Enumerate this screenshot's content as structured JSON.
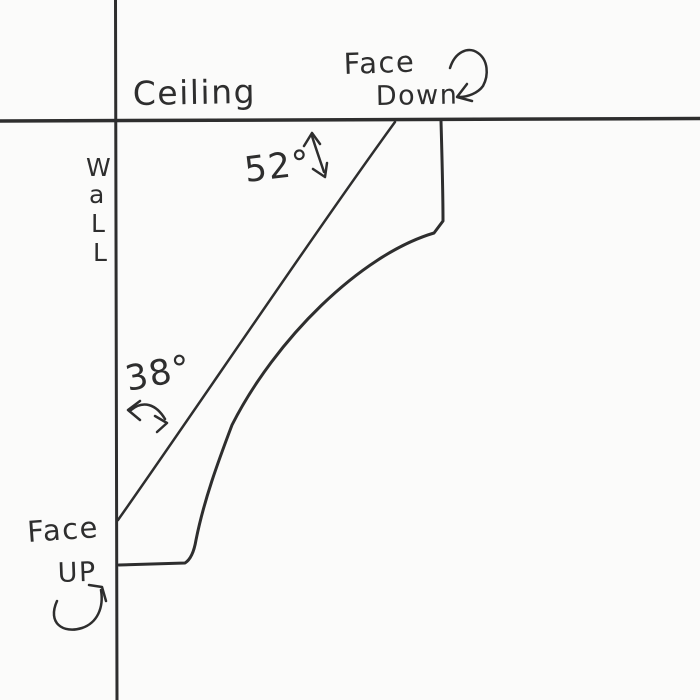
{
  "labels": {
    "ceiling": "Ceiling",
    "wall_letters": [
      "W",
      "a",
      "L",
      "L"
    ],
    "face_down_line1": "Face",
    "face_down_line2": "Down",
    "face_up_line1": "Face",
    "face_up_line2": "UP",
    "ceiling_angle": "52°",
    "wall_angle": "38°"
  },
  "colors": {
    "ink": "#2e2e2e",
    "paper": "#fbfbfa"
  }
}
